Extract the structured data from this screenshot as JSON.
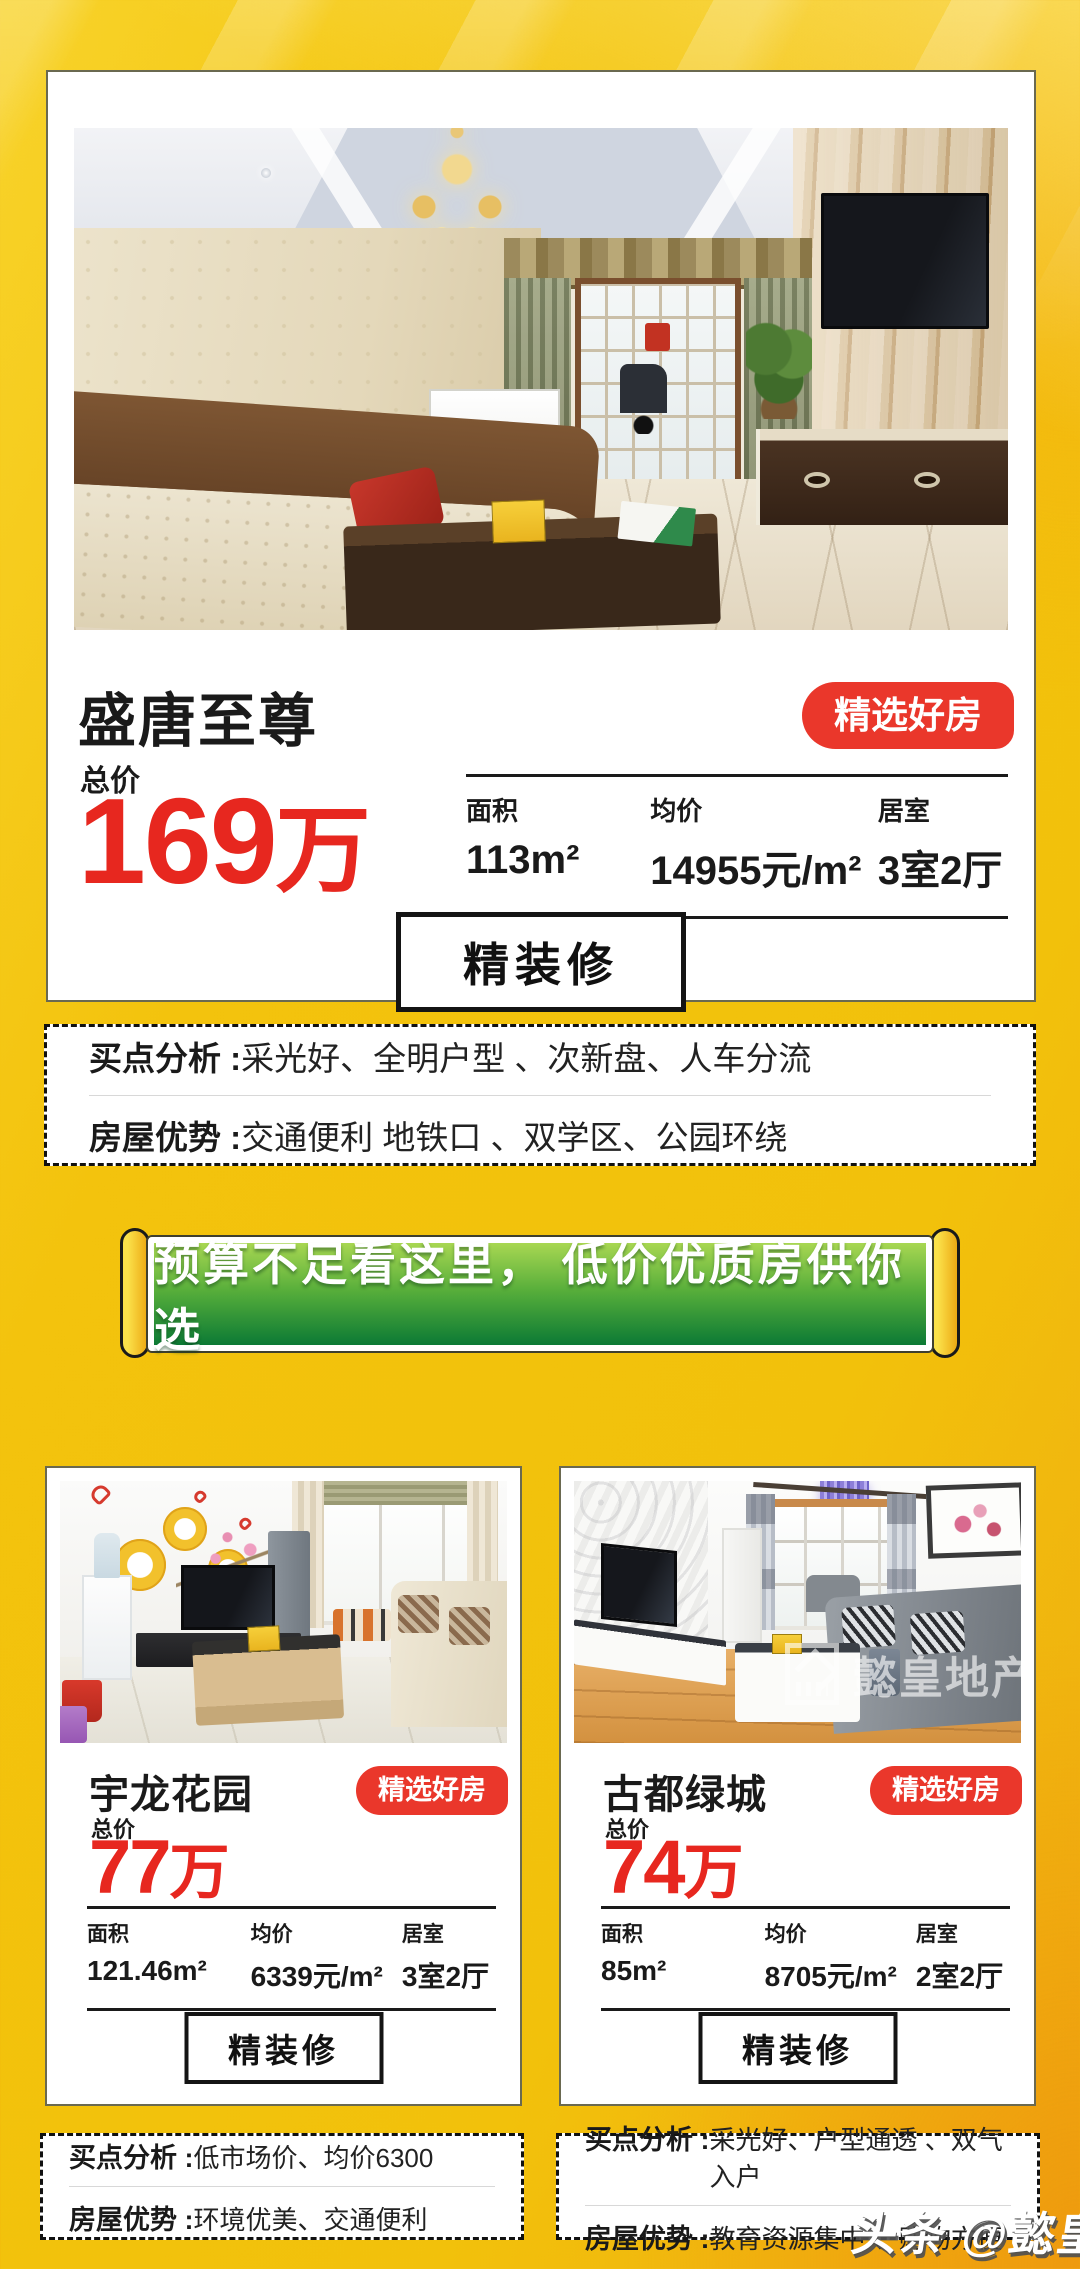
{
  "colors": {
    "background_gold": "#f2c10b",
    "accent_red": "#e7271f",
    "badge_red": "#ea372b",
    "banner_green_top": "#a8d752",
    "banner_green_bottom": "#0c7a35",
    "text_black": "#1a1a1a"
  },
  "page": {
    "watermark": "头条 @懿皇地产"
  },
  "featured": {
    "title": "盛唐至尊",
    "badge": "精选好房",
    "price_label": "总价",
    "price_value": "169",
    "price_unit": "万",
    "stats": [
      {
        "label": "面积",
        "value": "113m²"
      },
      {
        "label": "均价",
        "value": "14955元/m²"
      },
      {
        "label": "居室",
        "value": "3室2厅"
      }
    ],
    "decorate_label": "精装修",
    "analysis": [
      {
        "label": "买点分析 :",
        "text": "采光好、全明户型 、次新盘、人车分流"
      },
      {
        "label": "房屋优势 :",
        "text": "交通便利 地铁口 、双学区、公园环绕"
      }
    ]
  },
  "banner": {
    "text": "预算不足看这里， 低价优质房供你选"
  },
  "listings": [
    {
      "title": "宇龙花园",
      "badge": "精选好房",
      "price_label": "总价",
      "price_value": "77",
      "price_unit": "万",
      "stats": [
        {
          "label": "面积",
          "value": "121.46m²"
        },
        {
          "label": "均价",
          "value": "6339元/m²"
        },
        {
          "label": "居室",
          "value": "3室2厅"
        }
      ],
      "decorate_label": "精装修",
      "analysis": [
        {
          "label": "买点分析 :",
          "text": "低市场价、均价6300"
        },
        {
          "label": "房屋优势 :",
          "text": "环境优美、交通便利"
        }
      ]
    },
    {
      "title": "古都绿城",
      "badge": "精选好房",
      "price_label": "总价",
      "price_value": "74",
      "price_unit": "万",
      "stats": [
        {
          "label": "面积",
          "value": "85m²"
        },
        {
          "label": "均价",
          "value": "8705元/m²"
        },
        {
          "label": "居室",
          "value": "2室2厅"
        }
      ],
      "decorate_label": "精装修",
      "photo_watermark": "懿皇地产",
      "analysis": [
        {
          "label": "买点分析 :",
          "text": "采光好、户型通透 、双气入户"
        },
        {
          "label": "房屋优势 :",
          "text": "教育资源集中 、购物方便"
        }
      ]
    }
  ]
}
